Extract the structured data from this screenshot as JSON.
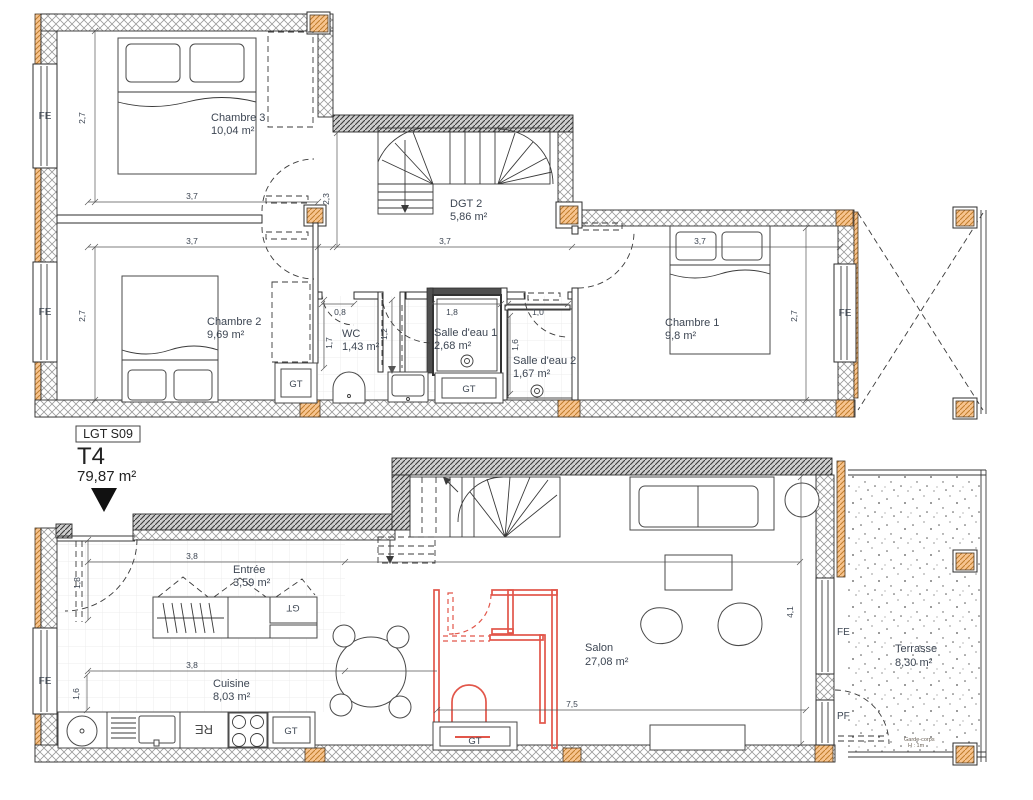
{
  "unit": {
    "code": "LGT S09",
    "type": "T4",
    "area": "79,87 m²"
  },
  "upper": {
    "rooms": {
      "chambre3": {
        "name": "Chambre 3",
        "area": "10,04 m²"
      },
      "dgt2": {
        "name": "DGT 2",
        "area": "5,86 m²"
      },
      "chambre2": {
        "name": "Chambre 2",
        "area": "9,69 m²"
      },
      "wc": {
        "name": "WC",
        "area": "1,43 m²"
      },
      "sde1": {
        "name": "Salle d'eau 1",
        "area": "2,68 m²"
      },
      "sde2": {
        "name": "Salle d'eau 2",
        "area": "1,67 m²"
      },
      "chambre1": {
        "name": "Chambre 1",
        "area": "9,8 m²"
      }
    },
    "dims": {
      "w_ch3": "3,7",
      "w_ch2": "3,7",
      "w_stair": "3,7",
      "w_ch1": "3,7",
      "h_ch3": "2,7",
      "h_ch2": "2,7",
      "h_ch1": "2,7",
      "h_stair": "2,3",
      "wc_w": "0,8",
      "wc_d": "1,7",
      "pocket": "1,2",
      "sde1_w": "1,8",
      "sde2_w": "1,0",
      "sde2_d": "1,6"
    },
    "labels": {
      "fe": "FE",
      "gt": "GT"
    }
  },
  "lower": {
    "rooms": {
      "entree": {
        "name": "Entrée",
        "area": "3,59 m²"
      },
      "cuisine": {
        "name": "Cuisine",
        "area": "8,03 m²"
      },
      "salon": {
        "name": "Salon",
        "area": "27,08 m²"
      },
      "terrasse": {
        "name": "Terrasse",
        "area": "8,30 m²"
      }
    },
    "dims": {
      "entree_w": "3,8",
      "cuisine_w": "3,8",
      "entree_d": "1,8",
      "cuisine_d": "1,6",
      "salon_w": "7,5",
      "salon_d": "4,1"
    },
    "labels": {
      "fe": "FE",
      "pf": "PF",
      "gt": "GT",
      "re": "RE",
      "guardrail_line1": "Garde-corps",
      "guardrail_line2": "H : 1m"
    }
  },
  "colors": {
    "red": "#e2564a",
    "orange": "#f7c48f",
    "text": "#3d4653",
    "line": "#2e2e2e"
  }
}
